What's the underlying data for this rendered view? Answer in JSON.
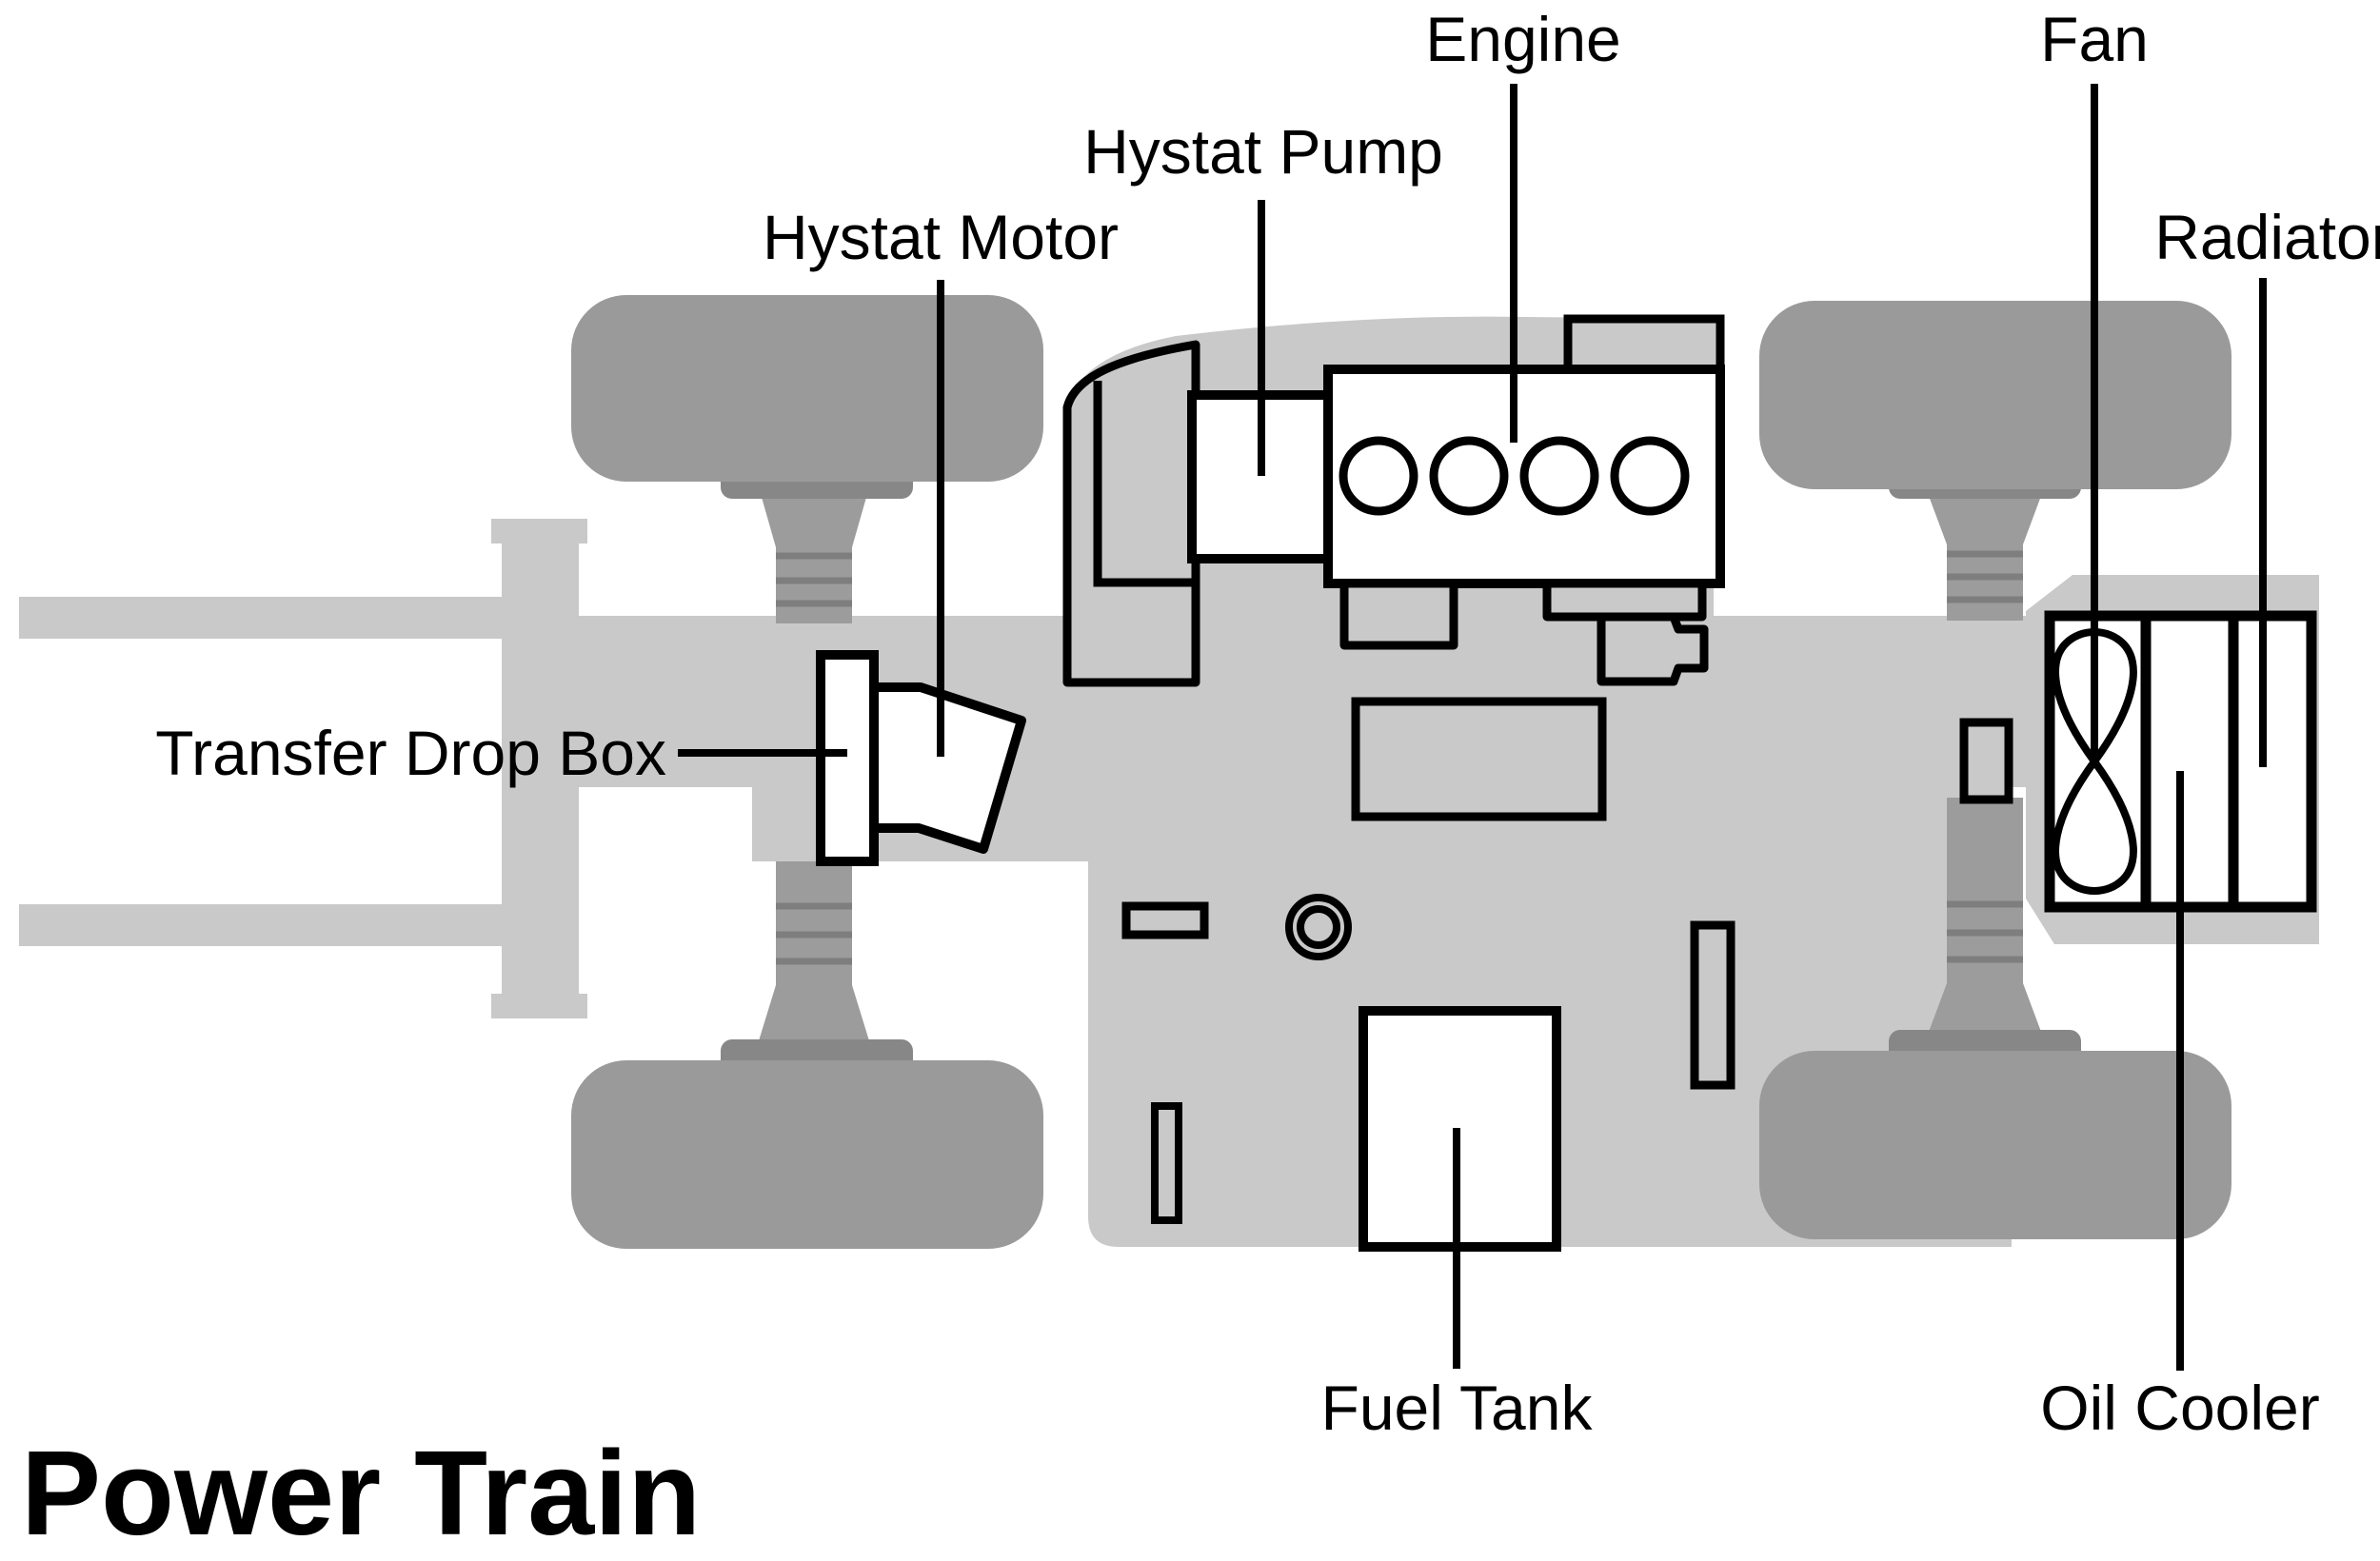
{
  "title": "Power Train",
  "labels": {
    "engine": "Engine",
    "fan": "Fan",
    "hystat_pump": "Hystat Pump",
    "hystat_motor": "Hystat Motor",
    "radiator": "Radiator",
    "transfer_drop_box": "Transfer Drop Box",
    "fuel_tank": "Fuel Tank",
    "oil_cooler": "Oil Cooler"
  },
  "colors": {
    "background": "#ffffff",
    "chassis_gray": "#c9c9c9",
    "wheel_gray": "#9a9a9a",
    "axle_gray": "#9c9c9c",
    "flange_gray": "#878787",
    "rung_gray": "#7e7e7e",
    "outline_black": "#000000"
  }
}
